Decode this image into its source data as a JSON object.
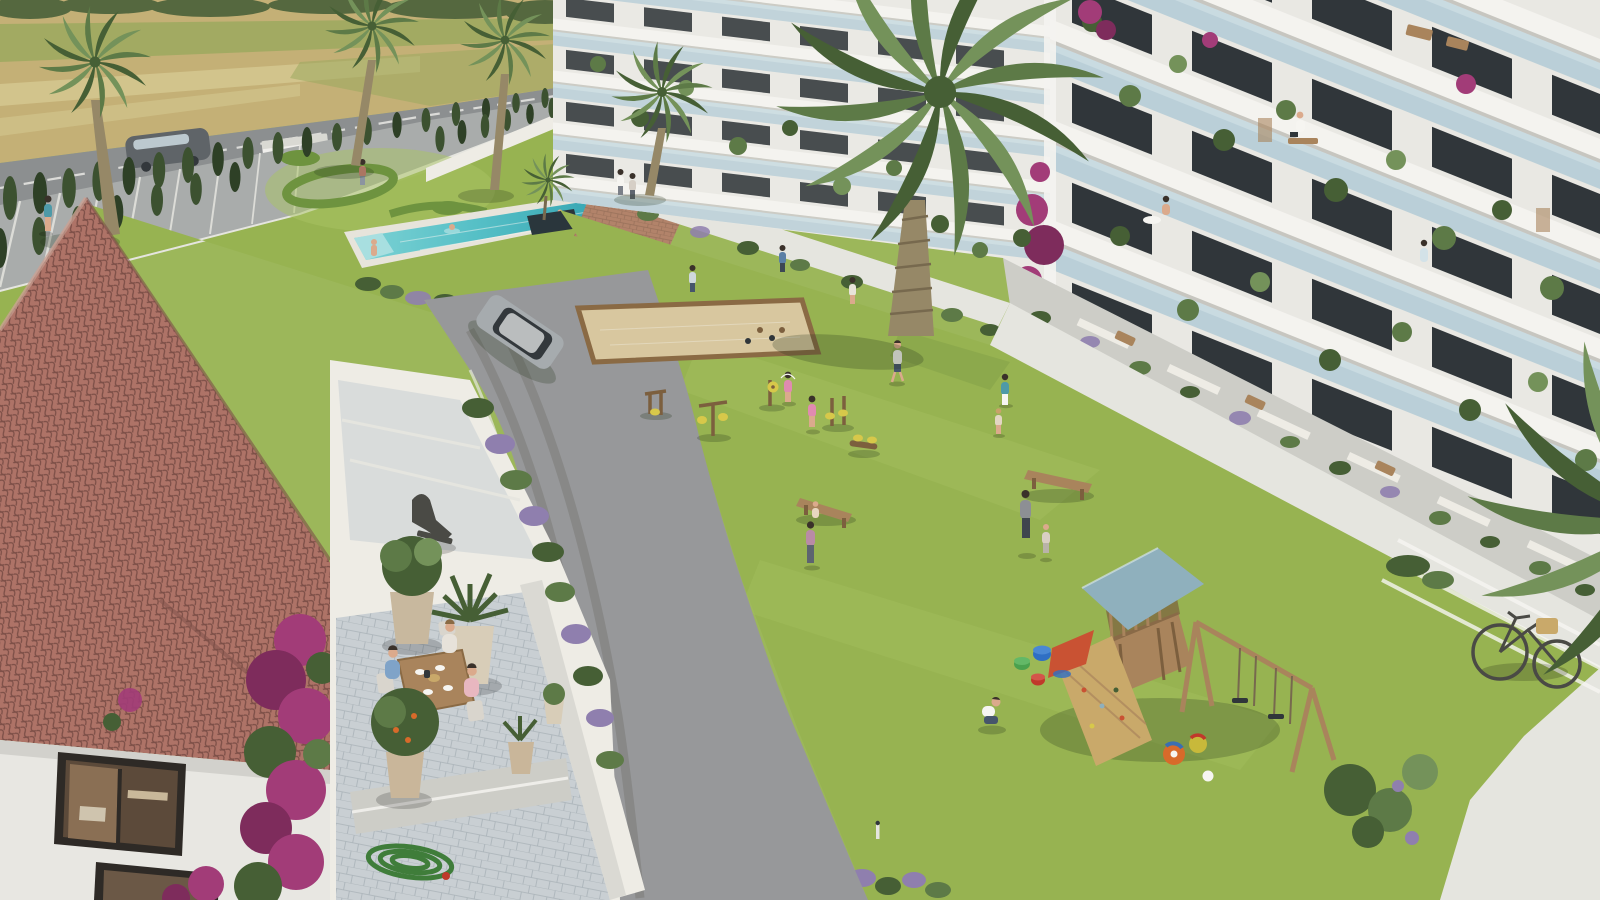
{
  "meta": {
    "title": "Aerial architectural rendering of a residential complex courtyard",
    "description": "3D visualization seen from above: modern white apartment buildings with glass balconies and potted plants on the right; landscaped courtyard with lawn, swimming pool, petanque court, outdoor gym, wooden playground and benches in the center; Mediterranean building with terracotta tile roof, bougainvillea and a cafe terrace in the foreground left; farmland, a road with vehicles, parking and cypress rows in the background.",
    "width_px": 1600,
    "height_px": 900
  },
  "colors": {
    "fieldGold": "#c4b076",
    "fieldGold2": "#d2c48c",
    "fieldGreen": "#9aa95e",
    "treeDark": "#55683f",
    "roadAsphalt": "#8c8f90",
    "parking": "#a9acab",
    "curb": "#e5e5df",
    "roadLine": "#e9e9e5",
    "cypress": "#3c5130",
    "cypressDark": "#2e4026",
    "wallWhite": "#eeece5",
    "lawn": "#97b351",
    "lawnLight": "#a9c464",
    "lawnShade": "#7e9a45",
    "hedge": "#6e933f",
    "poolWater": "#55bfc6",
    "poolDeep": "#2f9fae",
    "poolStep": "#a8dfe0",
    "deck": "#e7e4db",
    "pond": "#2a363c",
    "plazaBrick": "#b2836a",
    "plazaLine": "#97705a",
    "path": "#97989a",
    "tire": "#807f7d",
    "sand": "#d8c79f",
    "woodFrame": "#8a6a44",
    "wood": "#a9845c",
    "woodDark": "#7c5f3e",
    "facade": "#e9e8e3",
    "slab": "#f4f3ef",
    "slabShadow": "#c7c6c0",
    "glass": "#b5ccd6",
    "glassLight": "#d3e2e8",
    "windowDark": "#30363a",
    "terrace": "#cdcdc7",
    "paver": "#c9cfd3",
    "paverLine": "#a9b2b8",
    "stucco": "#e8e7e2",
    "stuccoShade": "#d2d1cc",
    "roofTile": "#b5786c",
    "roofDark": "#7d4f47",
    "roofLight": "#cf9a89",
    "bougain": "#a23c78",
    "bougainDark": "#7e2c5c",
    "leaf": "#5d7a47",
    "leafDark": "#465f35",
    "leafLight": "#74925a",
    "lavender": "#8f7fae",
    "trunk": "#968867",
    "trunkDark": "#77694e",
    "skin": "#dbaa8c",
    "hairDark": "#3a312a",
    "suv": "#a6abae",
    "suvDark": "#33383c",
    "van": "#5f6468",
    "truckWhite": "#f0efec",
    "carRed": "#c23a35",
    "gymYellow": "#d7c84a",
    "playRoof": "#8fb0bd",
    "slideRed": "#c95233",
    "hose": "#3f7d3a",
    "steel": "#4a4a45",
    "basket": "#c9a96a",
    "white": "#f6f5f1",
    "shadow": "rgba(35,50,28,0.25)",
    "shadow2": "rgba(0,0,0,0.18)"
  },
  "scene": {
    "background": {
      "farmland": "harvested golden fields with green crop rows and a distant tree line",
      "road": {
        "surface": "asphalt with dashed white center line",
        "vehicles": [
          {
            "name": "gray-van",
            "color": "dark gray"
          },
          {
            "name": "white-box-truck",
            "color": "white with red logo"
          },
          {
            "name": "red-car",
            "color": "red"
          }
        ]
      },
      "parking": {
        "markings": "white striped bays",
        "screening": "two converging rows of cypress trees"
      }
    },
    "buildings": [
      {
        "name": "apartment-wing-far",
        "style": "modern white facade, continuous balcony slabs, glass balustrades, dark window walls, potted plants",
        "floors_visible": 5
      },
      {
        "name": "apartment-wing-near",
        "style": "modern white facade, deep balconies with furniture, bookshelves behind glazing, bougainvillea at the corner",
        "floors_visible": 5
      },
      {
        "name": "mediterranean-building-foreground",
        "roof": "terracotta barrel tiles",
        "walls": "white stucco",
        "features": [
          "dark framed window",
          "climbing bougainvillea",
          "cafe terrace",
          "stepped terraces with large pots",
          "bronze statue",
          "coiled garden hose"
        ]
      }
    ],
    "amenities": [
      {
        "name": "swimming-pool",
        "water": "turquoise",
        "swimmers": 3,
        "edge": "white deck with lavender border"
      },
      {
        "name": "ornamental-garden",
        "detail": "sculpted hedge rings on lawn"
      },
      {
        "name": "petanque-court",
        "surface": "sand",
        "frame": "timber"
      },
      {
        "name": "outdoor-gym",
        "machines": 5,
        "accent_color": "yellow on brown posts"
      },
      {
        "name": "playground",
        "items": [
          "wooden tower",
          "blue canopy roof",
          "climbing wall",
          "double swing set",
          "red slide",
          "toy buckets",
          "beach balls"
        ]
      },
      {
        "name": "wooden-benches",
        "count": 2
      },
      {
        "name": "curved-asphalt-path",
        "detail": "tire marks, silver SUV driving"
      },
      {
        "name": "bicycle",
        "detail": "city bike with wicker basket leaning on white wall"
      }
    ],
    "vegetation": {
      "palm-trees": 7,
      "cypress-trees": 32,
      "lavender-shrubs": "many along borders",
      "bougainvillea-clusters": 5,
      "balcony-potted-plants": "numerous"
    },
    "people": {
      "count": 26,
      "activities": [
        "dining on terrace",
        "swimming",
        "walking",
        "jumping rope",
        "lifting a child",
        "playing with toys",
        "working at balcony desk",
        "tending balcony plants"
      ]
    }
  }
}
